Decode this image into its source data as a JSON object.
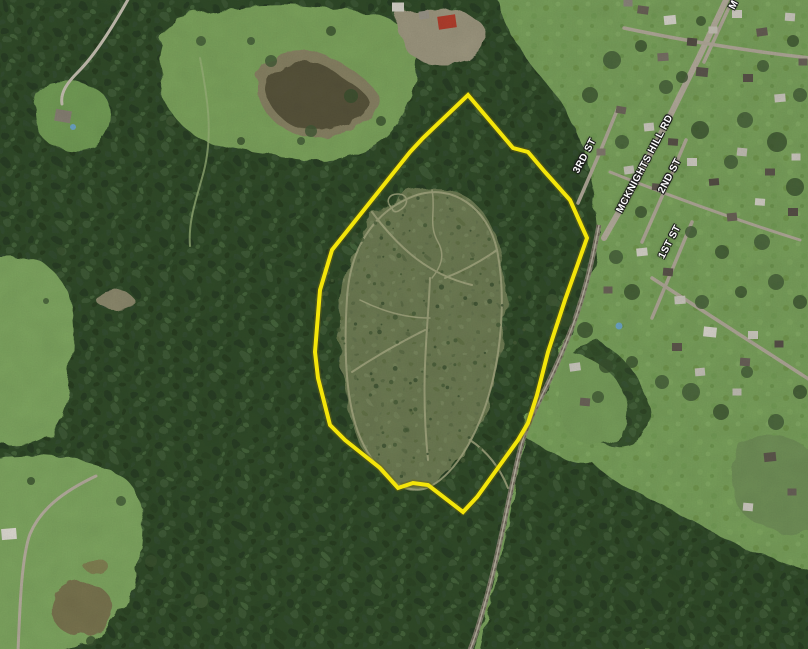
{
  "map": {
    "description": "Aerial satellite view of a wooded property with outlined parcel boundary beside a small residential street grid and rail corridor",
    "street_labels": [
      {
        "id": "3rd-st",
        "text": "3RD ST"
      },
      {
        "id": "mcknights-hill-rd",
        "text": "MCKNIGHTS HILL RD"
      },
      {
        "id": "2nd-st",
        "text": "2ND ST"
      },
      {
        "id": "1st-st",
        "text": "1ST ST"
      },
      {
        "id": "top-partial",
        "text": "M"
      }
    ],
    "boundary": {
      "color": "#f3e50a",
      "outline_color": "#6b6410",
      "points": "468,95 513,148 528,152 545,172 570,200 587,238 565,300 548,352 537,395 528,423 518,440 477,497 463,512 428,485 413,483 398,488 380,468 360,452 345,440 330,425 318,378 315,352 320,290 332,250 410,152 423,138"
    },
    "palette": {
      "field_green": "#7ca45e",
      "forest_green": "#334d2c",
      "meadow_olive": "#6f7e55",
      "trail_tan": "#a9ac85",
      "road_gray": "#b6ae9e",
      "railroad_gray": "#9b9383",
      "pond_brown": "#5a563c",
      "pool_blue": "#6fa8c8",
      "barn_red": "#b5402e",
      "boundary_yellow": "#f3e50a"
    }
  }
}
